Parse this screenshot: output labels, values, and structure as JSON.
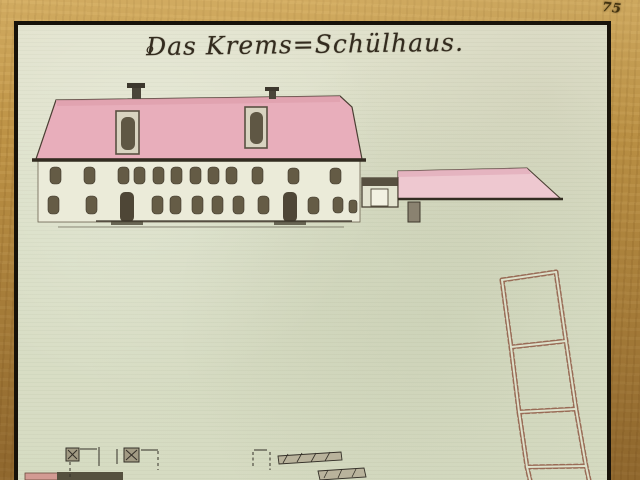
{
  "page": {
    "number": "75",
    "ornament": "o",
    "title": "Das Krems=Schülhaus."
  },
  "colors": {
    "margin_tan": "#bd9245",
    "frame_black": "#171209",
    "paper": "#dde1cb",
    "facade_cream": "#ebebd9",
    "roof_pink": "#e8aebb",
    "annex_roof_pink": "#eec8d0",
    "window_ink": "#645b45",
    "door_ink": "#4e4636",
    "ground_ink": "#3a3328",
    "plan_dash_red": "#93604b",
    "title_ink": "#332b1e"
  }
}
